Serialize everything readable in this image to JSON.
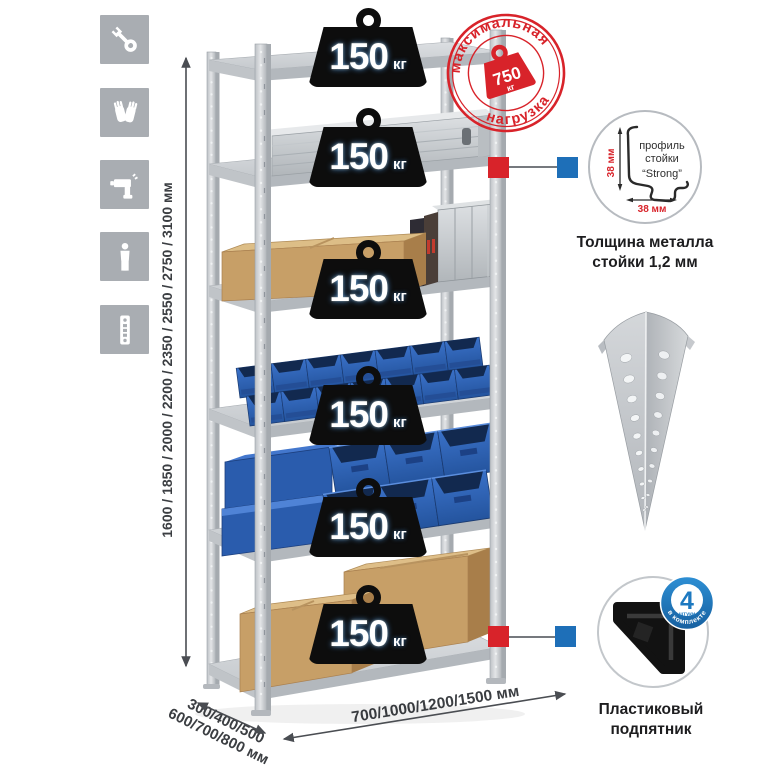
{
  "assembly_icons": [
    {
      "name": "wrench"
    },
    {
      "name": "gloves"
    },
    {
      "name": "drill"
    },
    {
      "name": "person"
    },
    {
      "name": "perforated-post"
    }
  ],
  "dimensions": {
    "height": "1600 / 1850 / 2000 / 2200 / 2350 / 2550 / 2750 / 3100 мм",
    "depth_line1": "300/400/500",
    "depth_line2": "600/700/800 мм",
    "width": "700/1000/1200/1500 мм"
  },
  "shelf_badge": {
    "value": "150",
    "unit": "кг"
  },
  "max_load_stamp": {
    "arc_top": "максимальная",
    "arc_bottom": "нагрузка",
    "value": "750",
    "unit": "кг"
  },
  "profile_detail": {
    "label_line1": "профиль",
    "label_line2": "стойки",
    "label_line3": "“Strong”",
    "dim_vertical": "38 мм",
    "dim_horizontal": "38 мм",
    "caption_line1": "Толщина металла",
    "caption_line2": "стойки 1,2 мм"
  },
  "foot_detail": {
    "badge_value": "4",
    "badge_small": "штуки",
    "badge_arc": "в комплекте",
    "caption_line1": "Пластиковый",
    "caption_line2": "подпятник"
  },
  "colors": {
    "accent_red": "#d8232a",
    "accent_blue": "#1e6fb8",
    "icon_gray": "#a9adb2",
    "metal_gray": "#ccd0d3",
    "bin_blue": "#2f66ba",
    "cardboard": "#c79f67"
  }
}
